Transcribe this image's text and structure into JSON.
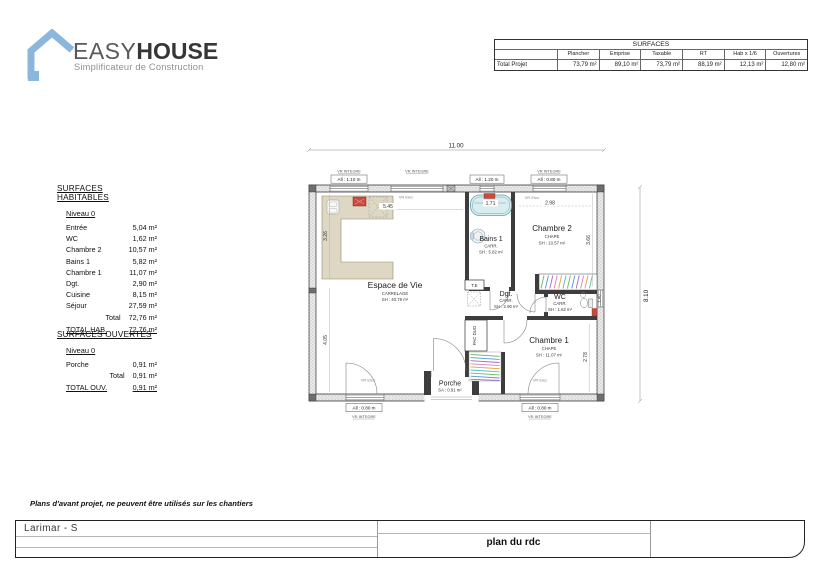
{
  "logo": {
    "brand_1": "EASY",
    "brand_2": "HOUSE",
    "tagline": "Simplificateur de Construction",
    "accent_color": "#8cb7dc"
  },
  "surfaces_table": {
    "title": "SURFACES",
    "row_label": "Total Projet",
    "columns": [
      "Plancher",
      "Emprise",
      "Taxable",
      "RT",
      "Hab x 1/6",
      "Ouvertures"
    ],
    "values": [
      "73,79 m²",
      "89,10 m²",
      "73,79 m²",
      "88,19 m²",
      "12,13 m²",
      "12,80 m²"
    ]
  },
  "habitables": {
    "title": "SURFACES HABITABLES",
    "level": "Niveau 0",
    "rows": [
      {
        "label": "Entrée",
        "value": "5,04 m²"
      },
      {
        "label": "WC",
        "value": "1,62 m²"
      },
      {
        "label": "Chambre 2",
        "value": "10,57 m²"
      },
      {
        "label": "Bains 1",
        "value": "5,82 m²"
      },
      {
        "label": "Chambre 1",
        "value": "11,07 m²"
      },
      {
        "label": "Dgt.",
        "value": "2,90 m²"
      },
      {
        "label": "Cuisine",
        "value": "8,15 m²"
      },
      {
        "label": "Séjour",
        "value": "27,59 m²"
      }
    ],
    "total_label": "Total",
    "total_value": "72,76 m²",
    "grand_label": "TOTAL HAB.",
    "grand_value": "72,76 m²"
  },
  "ouvertes": {
    "title": "SURFACES OUVERTES",
    "level": "Niveau 0",
    "rows": [
      {
        "label": "Porche",
        "value": "0,91 m²"
      }
    ],
    "total_label": "Total",
    "total_value": "0,91 m²",
    "grand_label": "TOTAL OUV.",
    "grand_value": "0,91 m²"
  },
  "plan": {
    "dims": {
      "width": "11.00",
      "height": "8.10",
      "kitchen": "5.45",
      "bath": "1.71",
      "ch2": "2.98",
      "left_top": "3.26",
      "left_bottom": "4.05",
      "ch2_right": "3.66",
      "ch1_right": "2.78",
      "wc_right": "1.40"
    },
    "rooms": [
      {
        "name": "Espace de Vie",
        "finish": "CARRELAGE",
        "area": "SH : 40.78 m²"
      },
      {
        "name": "Bains 1",
        "finish": "CARR.",
        "area": "SH : 5.82 m²"
      },
      {
        "name": "Chambre 2",
        "finish": "CHAPE",
        "area": "SH : 10.57 m²"
      },
      {
        "name": "Dgt.",
        "finish": "CARR.",
        "area": "SH : 2.90 m²"
      },
      {
        "name": "WC",
        "finish": "CARR.",
        "area": "SH : 1.62 m²"
      },
      {
        "name": "Chambre 1",
        "finish": "CHAPE",
        "area": "SH : 11.07 m²"
      },
      {
        "name": "Porche",
        "area": "SA : 0.91 m²"
      }
    ],
    "labels": {
      "vr_integre": "VR INTEGRE",
      "vr_elec": "VR Elec",
      "te": "T.E",
      "pac": "PAC DUO"
    },
    "windows": [
      {
        "label": "All : 1.10 m"
      },
      {
        "label": "All : 1.20 m"
      },
      {
        "label": "All : 0.80 m"
      },
      {
        "label": "All : 0.80 m"
      },
      {
        "label": "All : 0.80 m"
      }
    ]
  },
  "note": "Plans d'avant projet, ne peuvent être utilisés sur les chantiers",
  "footer": {
    "project": "Larimar - S",
    "plan_title": "plan du rdc"
  }
}
